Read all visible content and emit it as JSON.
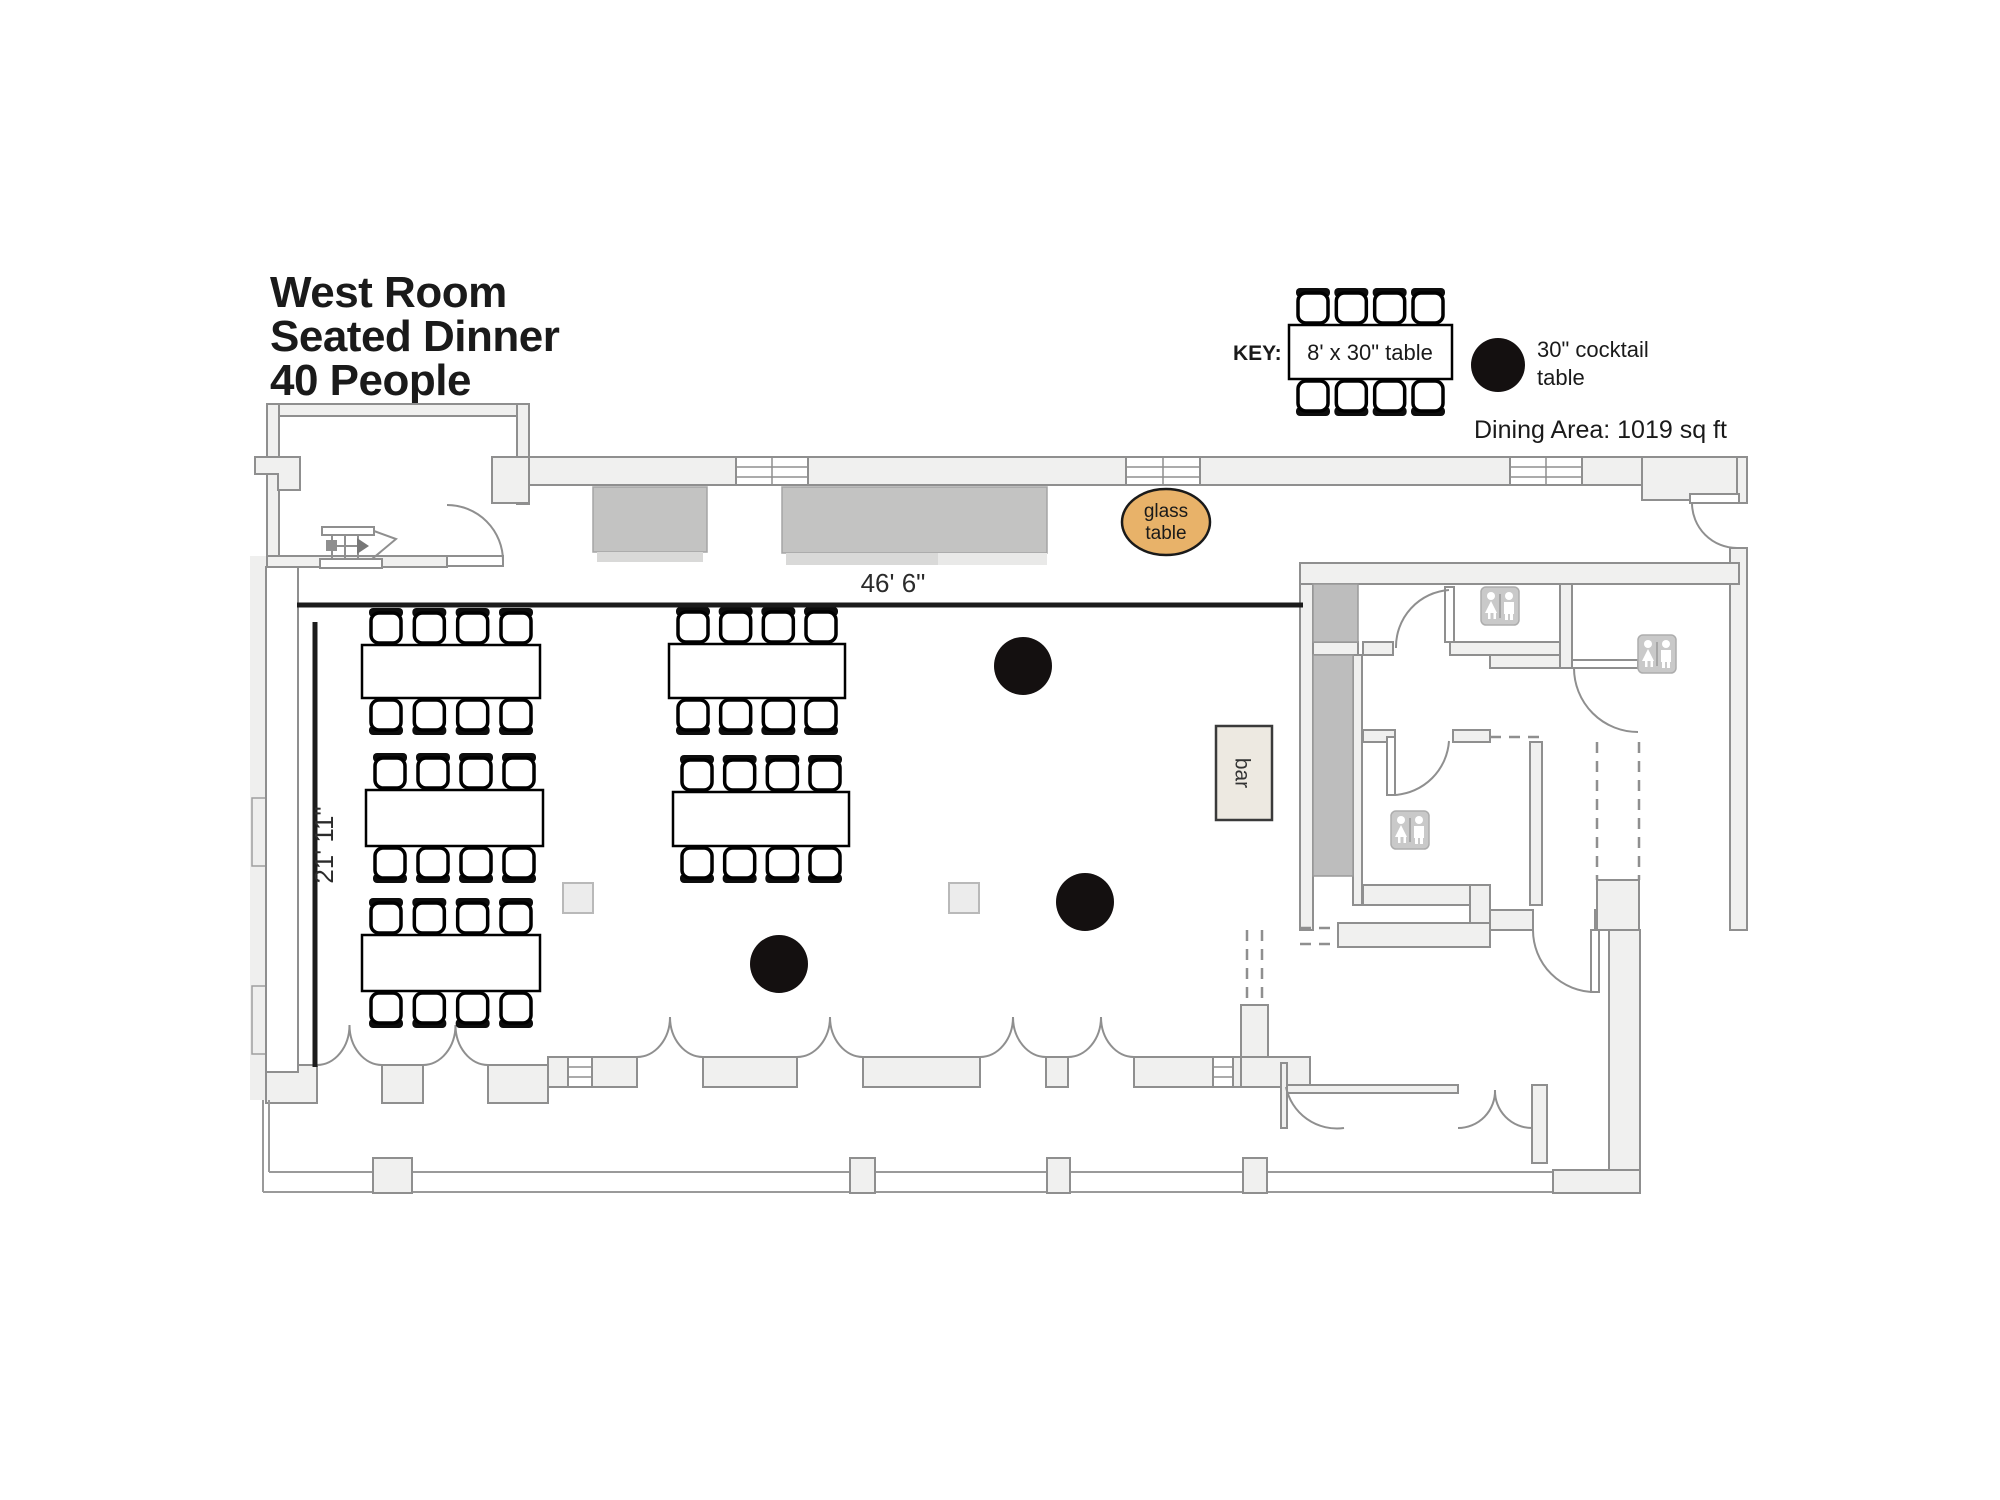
{
  "title": {
    "lines": [
      "West Room",
      "Seated Dinner",
      "40 People"
    ]
  },
  "key": {
    "label": "KEY:",
    "items": [
      {
        "name": "banquet-table",
        "label": "8' x 30\" table"
      },
      {
        "name": "cocktail-table",
        "label": "30\" cocktail table",
        "label_lines": [
          "30\" cocktail",
          "table"
        ]
      }
    ],
    "dining_area": "Dining Area: 1019 sq ft"
  },
  "dimensions": {
    "width_label": "46' 6\"",
    "depth_label": "21' 11\""
  },
  "room_labels": {
    "glass_table_lines": [
      "glass",
      "table"
    ],
    "bar": "bar"
  },
  "colors": {
    "glass_table_fill": "#e8b269",
    "bar_fill": "#ede9e1",
    "wall_fill": "#f0f0ef",
    "wall_stroke": "#8f8f8f",
    "furniture_black": "#141010"
  },
  "floorplan": {
    "banquet_tables": [
      {
        "x": 362,
        "y": 645,
        "w": 178,
        "h": 53
      },
      {
        "x": 366,
        "y": 790,
        "w": 177,
        "h": 56
      },
      {
        "x": 362,
        "y": 935,
        "w": 178,
        "h": 56
      },
      {
        "x": 669,
        "y": 644,
        "w": 176,
        "h": 54
      },
      {
        "x": 673,
        "y": 792,
        "w": 176,
        "h": 54
      }
    ],
    "chairs_per_table": 8,
    "cocktail_tables": [
      {
        "cx": 1023,
        "cy": 666
      },
      {
        "cx": 1085,
        "cy": 902
      },
      {
        "cx": 779,
        "cy": 964
      }
    ],
    "cocktail_radius": 29,
    "columns": [
      {
        "x": 563,
        "y": 883
      },
      {
        "x": 949,
        "y": 883
      }
    ],
    "glass_table": {
      "cx": 1166,
      "cy": 522,
      "rx": 44,
      "ry": 33
    },
    "bar": {
      "x": 1216,
      "y": 726,
      "w": 56,
      "h": 94
    }
  }
}
